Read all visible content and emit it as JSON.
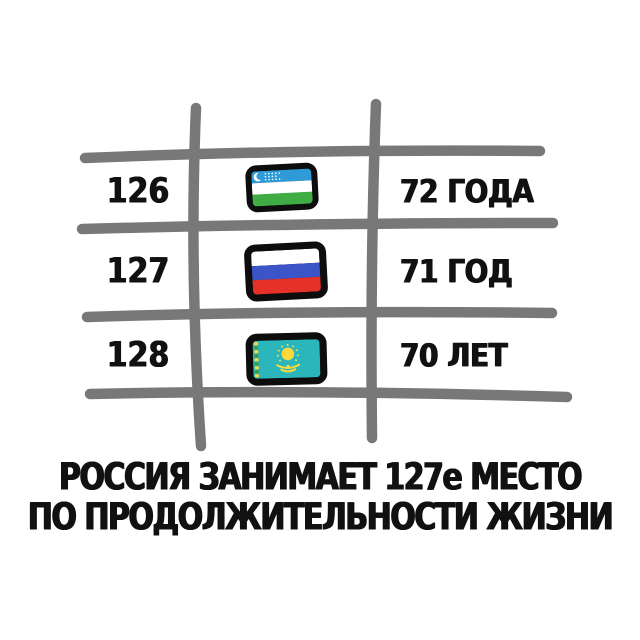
{
  "title_caption": {
    "line1": "РОССИЯ ЗАНИМАЕТ 127е МЕСТО",
    "line2": "ПО ПРОДОЛЖИТЕЛЬНОСТИ ЖИЗНИ"
  },
  "table": {
    "rows": [
      {
        "rank": "126",
        "flag": "uzbekistan-flag",
        "life_expectancy": "72 ГОДА"
      },
      {
        "rank": "127",
        "flag": "russia-flag",
        "life_expectancy": "71 ГОД"
      },
      {
        "rank": "128",
        "flag": "kazakhstan-flag",
        "life_expectancy": "70 ЛЕТ"
      }
    ]
  },
  "chart_data": {
    "type": "table",
    "columns": [
      "rank",
      "country_flag",
      "life_expectancy_label"
    ],
    "rows": [
      [
        126,
        "uzbekistan",
        "72 ГОДА"
      ],
      [
        127,
        "russia",
        "71 ГОД"
      ],
      [
        128,
        "kazakhstan",
        "70 ЛЕТ"
      ]
    ],
    "life_expectancy_years": [
      72,
      71,
      70
    ],
    "title": "РОССИЯ ЗАНИМАЕТ 127е МЕСТО ПО ПРОДОЛЖИТЕЛЬНОСТИ ЖИЗНИ",
    "grid": "hand-drawn 3x3 sketch grid"
  },
  "colors": {
    "background": "#ffffff",
    "grid_line": "#787878",
    "text": "#111111",
    "flag_border": "#0d0d0d",
    "uzbekistan_blue": "#2E9BD6",
    "uzbekistan_green": "#3FAC44",
    "russia_blue": "#3B55C8",
    "russia_red": "#E63129",
    "kazakhstan_turquoise": "#2AB6BB",
    "kazakhstan_yellow": "#FFD93B"
  }
}
